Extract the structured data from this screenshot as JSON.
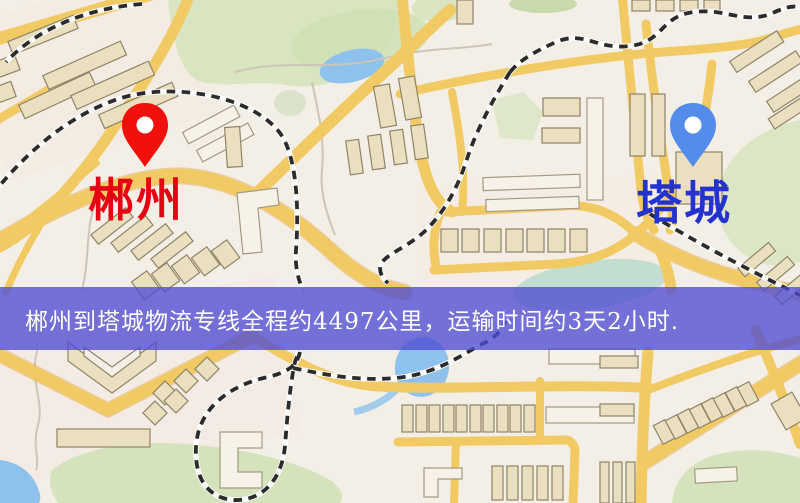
{
  "map": {
    "origin": {
      "label": "郴州"
    },
    "destination": {
      "label": "塔城"
    }
  },
  "banner": {
    "text": "郴州到塔城物流专线全程约4497公里，运输时间约3天2小时.",
    "origin": "郴州",
    "destination": "塔城",
    "distance": "约4497公里",
    "duration": "约3天2小时"
  },
  "colors": {
    "origin_pin": "#f2100d",
    "origin_label": "#e60012",
    "destination_pin": "#548ceb",
    "destination_label": "#2433cf",
    "banner_background": "rgba(78,76,212,0.78)",
    "banner_text": "#ffffff",
    "road": "#f1ca64",
    "park": "#d9e5c1",
    "water": "#8ec2ec",
    "building": "#eadfbf",
    "railway": "#2b2b2b",
    "map_base": "#f4efe6"
  }
}
